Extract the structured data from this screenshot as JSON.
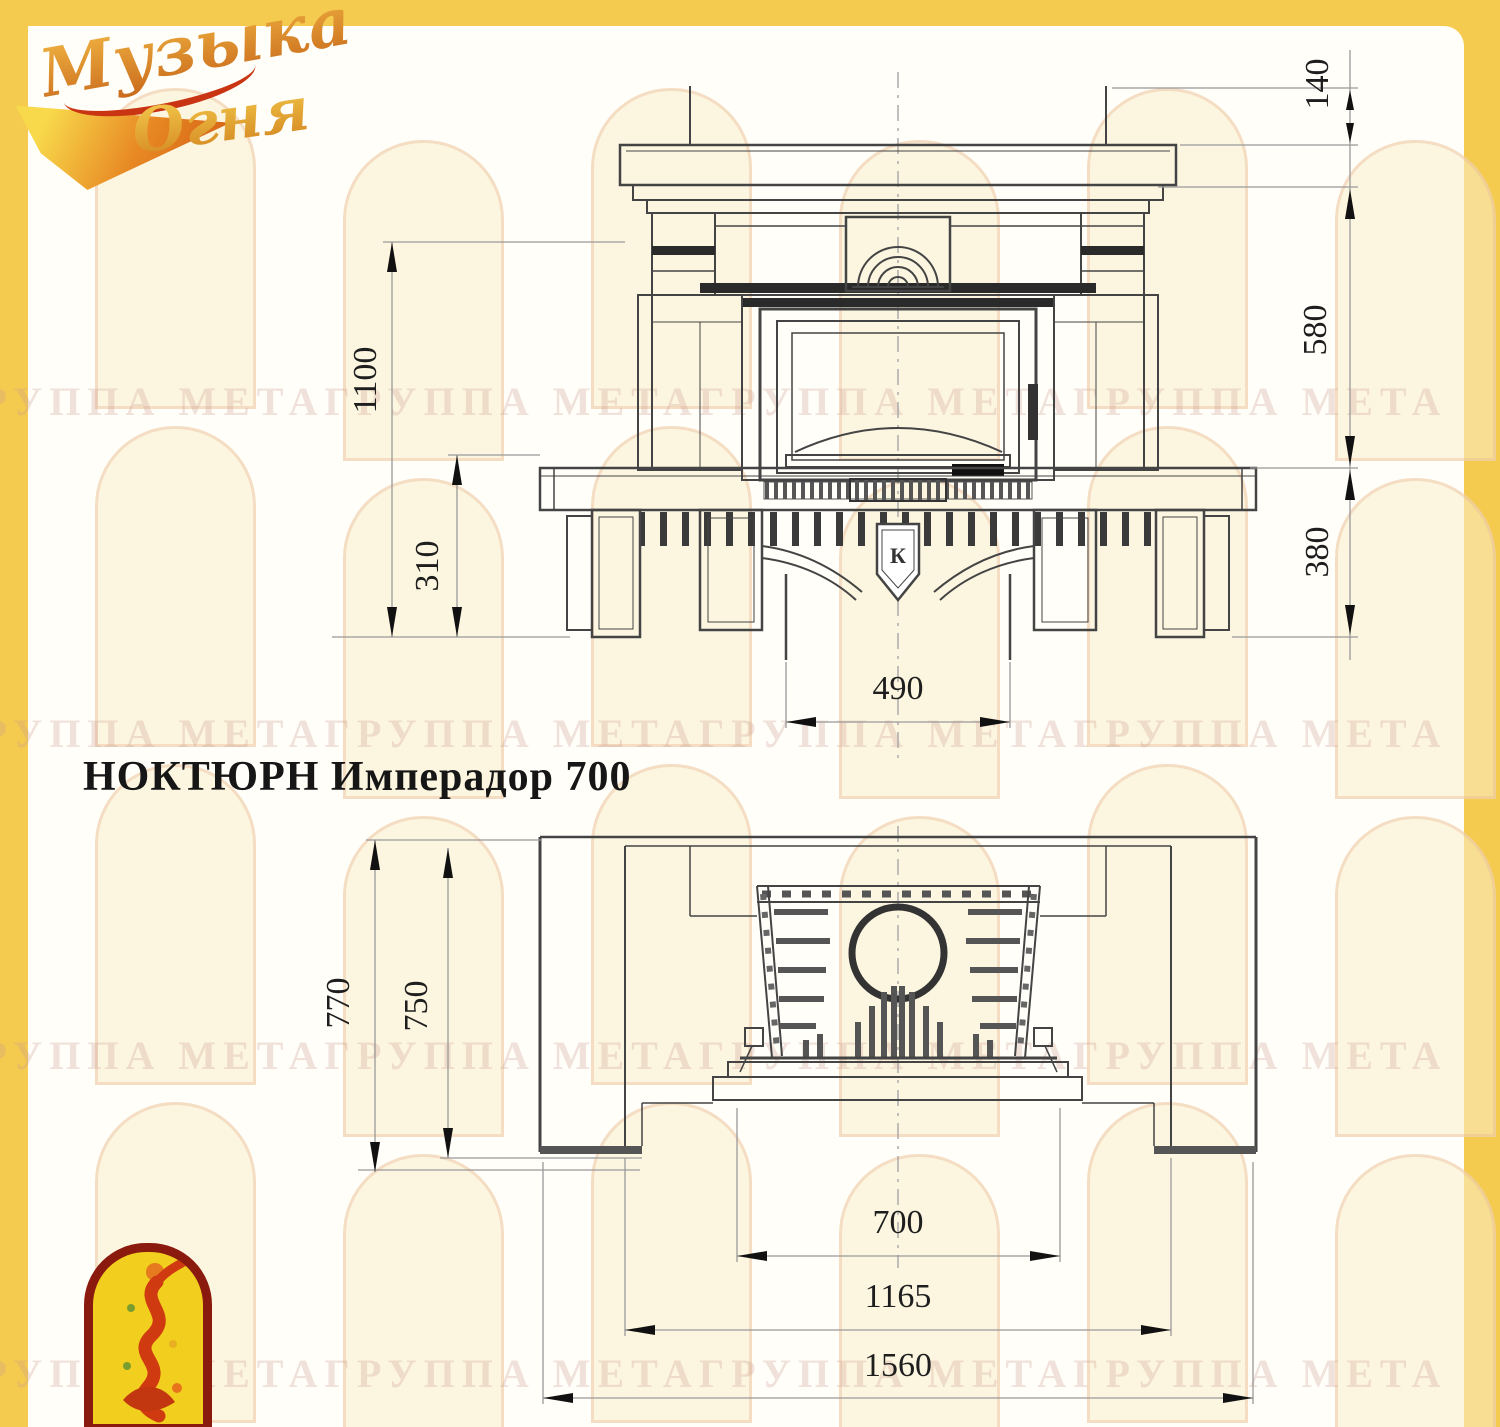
{
  "page": {
    "title": "НОКТЮРН Имперадор 700"
  },
  "logo": {
    "line1": "Музыка",
    "line2": "Огня"
  },
  "watermark": {
    "text": "ГРУППА МЕТАГРУППА МЕТАГРУППА МЕТАГРУППА МЕТА"
  },
  "front_view": {
    "keystone_mark": "К",
    "dims": {
      "total_height": "1100",
      "hearth_height": "310",
      "mantel_top": "140",
      "opening_height": "580",
      "base_height": "380",
      "duct_width": "490"
    }
  },
  "plan_view": {
    "dims": {
      "total_depth": "770",
      "body_depth": "750",
      "firebox_width": "700",
      "body_width": "1165",
      "total_width": "1560"
    }
  },
  "colors": {
    "frame": "#F4CB4E",
    "line": "#444444",
    "dim_line": "#999999",
    "label": "#1e1e1e"
  }
}
